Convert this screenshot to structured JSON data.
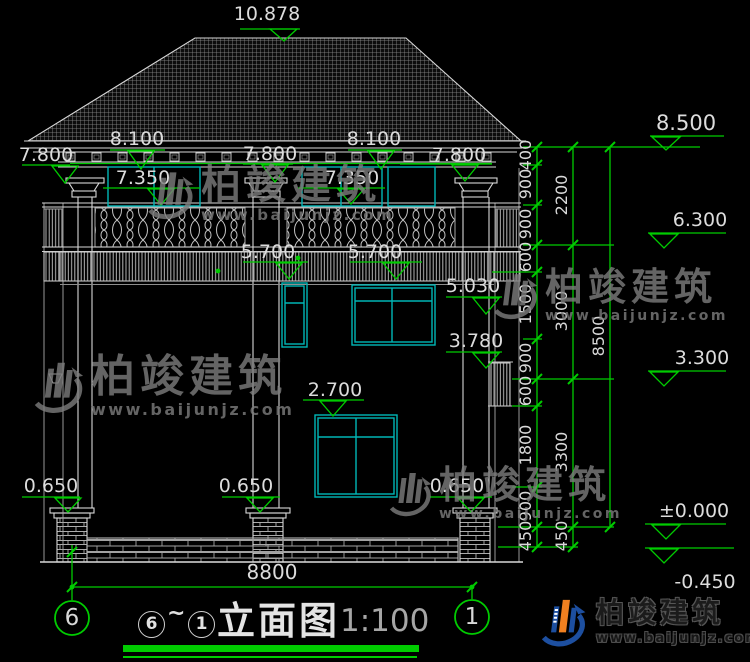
{
  "drawing": {
    "levels": {
      "ridge": "10.878",
      "eave": [
        "8.100",
        "8.100"
      ],
      "beam": [
        "7.800",
        "7.800",
        "7.800"
      ],
      "window_top_2f": [
        "7.350",
        "7.350"
      ],
      "balcony": [
        "5.700",
        "5.700"
      ],
      "side_window_top": "5.030",
      "side_window_sill": "3.780",
      "window_top_1f": "2.700",
      "column_base": [
        "0.650",
        "0.650",
        "0.650"
      ],
      "bottom_width": "8800"
    },
    "right_marks": [
      "8.500",
      "6.300",
      "3.300",
      "±0.000",
      "-0.450"
    ],
    "chains": {
      "inner": [
        "400",
        "900",
        "900",
        "600",
        "1500",
        "900",
        "600",
        "1800",
        "900",
        "450"
      ],
      "middle": [
        "2200",
        "3000",
        "3300",
        "450"
      ],
      "outer": [
        "8500"
      ]
    },
    "grid_bubbles": [
      "6",
      "1"
    ]
  },
  "title": {
    "from_bubble": "6",
    "tilde": "~",
    "to_bubble": "1",
    "name": "立面图",
    "scale": "1:100"
  },
  "watermark": {
    "name": "柏竣建筑",
    "url": "www.baijunjz.com"
  },
  "brand": {
    "name": "柏竣建筑",
    "url": "www.baijunjz.com"
  },
  "colors": {
    "dim_green": "#00cc00",
    "window_cyan": "#00b6b6",
    "line_white": "#d8d8d8",
    "brand_blue": "#1d4fa0",
    "brand_orange": "#f08020"
  }
}
